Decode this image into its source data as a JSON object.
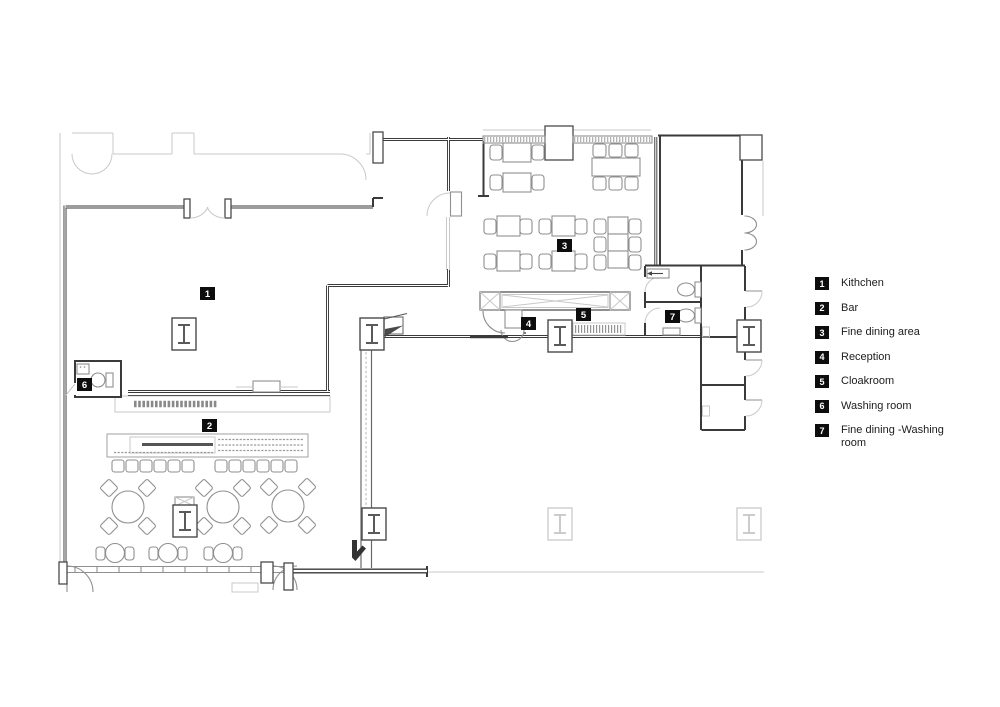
{
  "colors": {
    "background": "#ffffff",
    "wall": "#3a3a3a",
    "furniture": "#8f8f8f",
    "faint": "#c9c9c9",
    "marker_bg": "#0d0d0d",
    "marker_text": "#ffffff"
  },
  "plan": {
    "type": "restaurant-floor-plan",
    "markers": [
      "1",
      "2",
      "3",
      "4",
      "5",
      "6",
      "7"
    ]
  },
  "legend": {
    "items": [
      {
        "num": "1",
        "label": "Kithchen"
      },
      {
        "num": "2",
        "label": "Bar"
      },
      {
        "num": "3",
        "label": "Fine dining area"
      },
      {
        "num": "4",
        "label": "Reception"
      },
      {
        "num": "5",
        "label": "Cloakroom"
      },
      {
        "num": "6",
        "label": "Washing room"
      },
      {
        "num": "7",
        "label": "Fine dining -Washing room"
      }
    ]
  }
}
